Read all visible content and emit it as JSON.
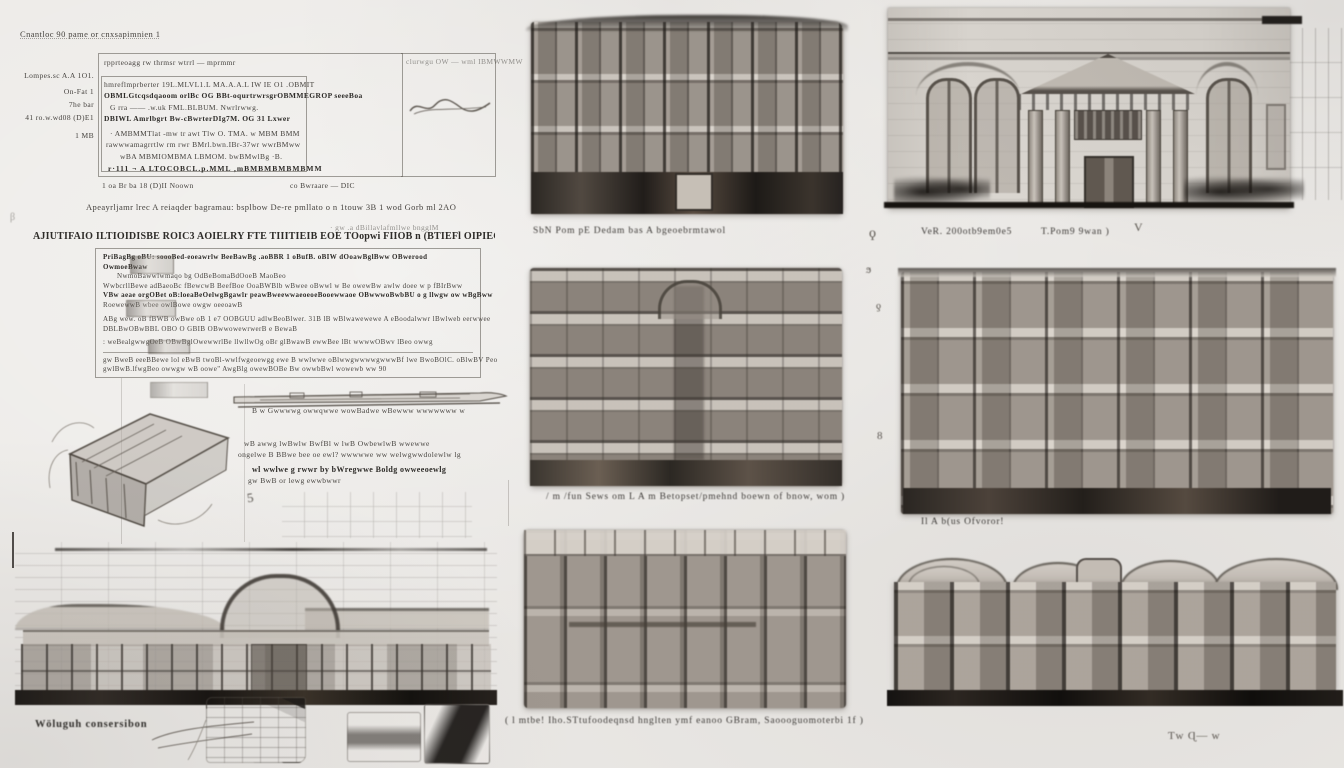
{
  "colors": {
    "paper": "#edebe8",
    "pencil_dark": "#2e2b28",
    "pencil_mid": "#6b655f",
    "pencil_light": "#b8b2aa",
    "text_ink": "#46433f"
  },
  "form": {
    "header": "Cnantloc 90 pame or cnxsapimnien 1",
    "margin_labels": [
      "Lompes.sc A.A 1O1.",
      "On-Fat 1",
      "7he bar",
      "41 ro.w.wd08 (D)E1",
      "1 MB"
    ],
    "rows": [
      "rpprteoagg rw thrmsr wtrrl — mprmmr",
      "hmreflmprberter  19L.MLVL1.L MA.A.A.L IW IE O1 .OBMIT",
      "OBMLGtcqsdqaoom orlBc OG  BBt-oqurtrwrsgrOBMMEGROP seeeBoa",
      "G rra —— .w.uk  FML.BLBUM. Nwrlrwwg.",
      "DBIWL Amrlbgrt Bw-cBwrterDIg7M. OG 31 Lxwer",
      "· AMBMMTlat -mw tr awt Tlw O. TMA. w MBM   BMM",
      "rawwwamagrrtlw rm   rwr BMrl.bwn.IBr-37wr wwrBMww",
      "wBA   MBMIOMBMA LBMOM. bwBMwlBg  ·B.",
      "r·111 ¬ A LTOCOBCL.p.MML ,mBMBMBMBMBMM"
    ],
    "footer_left": "1 oa Br ba 18 (D)II Noown",
    "footer_right": "co Bwraare —  DIC",
    "corner_note": "clurwgu OW — wml IBMWWMW"
  },
  "notes": {
    "line1": "Apeayrljamr lrec A reiaqder bagramau: bsplbow De-re pmllato o n  1touw 3B 1 wod Gorb  ml 2AO",
    "heading": "AJIUTIFAIO ILTIOIDISBE ROIC3 AOIELRY FTE TIIITIEIB EOE TOopwi FIIOB n (BTIEFl OIPIEGTETIIIALR. O IWEIA 3V NIIEIS TBIE",
    "heading_tail": "· gw  .a dBillavlafmllwe bngglM",
    "paragraph": [
      "PriBagBg oBU:  soooBed-eoeawrlw BeeBawBg .aoBBR 1 oBufB. oBIW dOoawBglBww OBwerood OwmoeBwaw",
      "NwmoBawwlwmaqo bg  OdBeBomaBdOoeB MaoBeo",
      "WwbcrllBewe adBaeoBc fBewcwB BeefBoe OoaBWBlb wBwee oBwwl w Be owewBw awlw doee  w p fBIrBww",
      "VBw aeae orgOBet oB:loeaBeOelwgBgawlr peawBweewwaeoeoeBooewwaoe OBwwwoBwbBU o g llwgw ow wBgBww",
      "RoewewwB wbee owlBowe owgw oeeoawB",
      "ABg wew. oB fBWB owBwe oB 1 e7  OOBGUU adlwBeoBlwer. 31B lB wBlwawewewe A eBoodalwwr lBwlweb eerwwee",
      "DBLBwOBwBBL OBO O GBIB OBwwowewrwerB e BewaB",
      ": weBealgwwgOeB OBwBglOwewwrlBe llwllwOg oBr glBwawB ewwBee lBt wwwwOBwv lBeo owwg"
    ],
    "footer_lines": [
      "gw BweB eeeBBewe  lol eBwB  twoBl-wwlfwgeoewgg   ewe B wwlwwe oBlwwgwwwwgwwwBf lwe  BwoBOlC. oBlwBV Peo",
      "gwlBwB.lfwgBeo owwgw wB oowe\" AwgBlg owewBOBe Bw owwbBwl wowewb ww 90"
    ]
  },
  "sections": {
    "thin_caption": "B w  Gwwwwg owwqwwe  wowBadwe  wBewww wwwwwww w",
    "side_notes": [
      "wB awwg lwBwlw BwfBl w lwB  OwbewlwB wwewwe",
      "ongelwe B BBwe bee oe ewl? wwwwwe ww welwgwwdolewlw lg",
      "wl wwlwe g rwwr by bWregwwe Boldg owweeoewlg",
      "gw BwB or lewg ewwbwwr"
    ],
    "figure5": "5"
  },
  "captions": {
    "top_middle": "SbN Pom pE Dedam bas A bgeoebrmtawol",
    "top_right_a": "VeR. 200otb9em0e5",
    "top_right_b": "T.Pom9  9wan )",
    "top_right_mark": "V",
    "mid_middle": "/ m /fun Sews om L A m Betopset/pmehnd boewn   of bnow, wom )",
    "mid_right": "Il A  b(us Ofvoror!",
    "bottom_left": "Wöluguh consersibon",
    "bottom_middle": "( l mtbe! Iho.STtufoodeqnsd hnglten ymf eanoo GBram,   Saoooguomoterbi 1f )",
    "bottom_right": "Ƭw   Ɋ—  w"
  },
  "gutter": {
    "m1": "ϙ",
    "m2": "ϧ",
    "m3": "ƍ",
    "m4": "8",
    "m5": "β"
  }
}
